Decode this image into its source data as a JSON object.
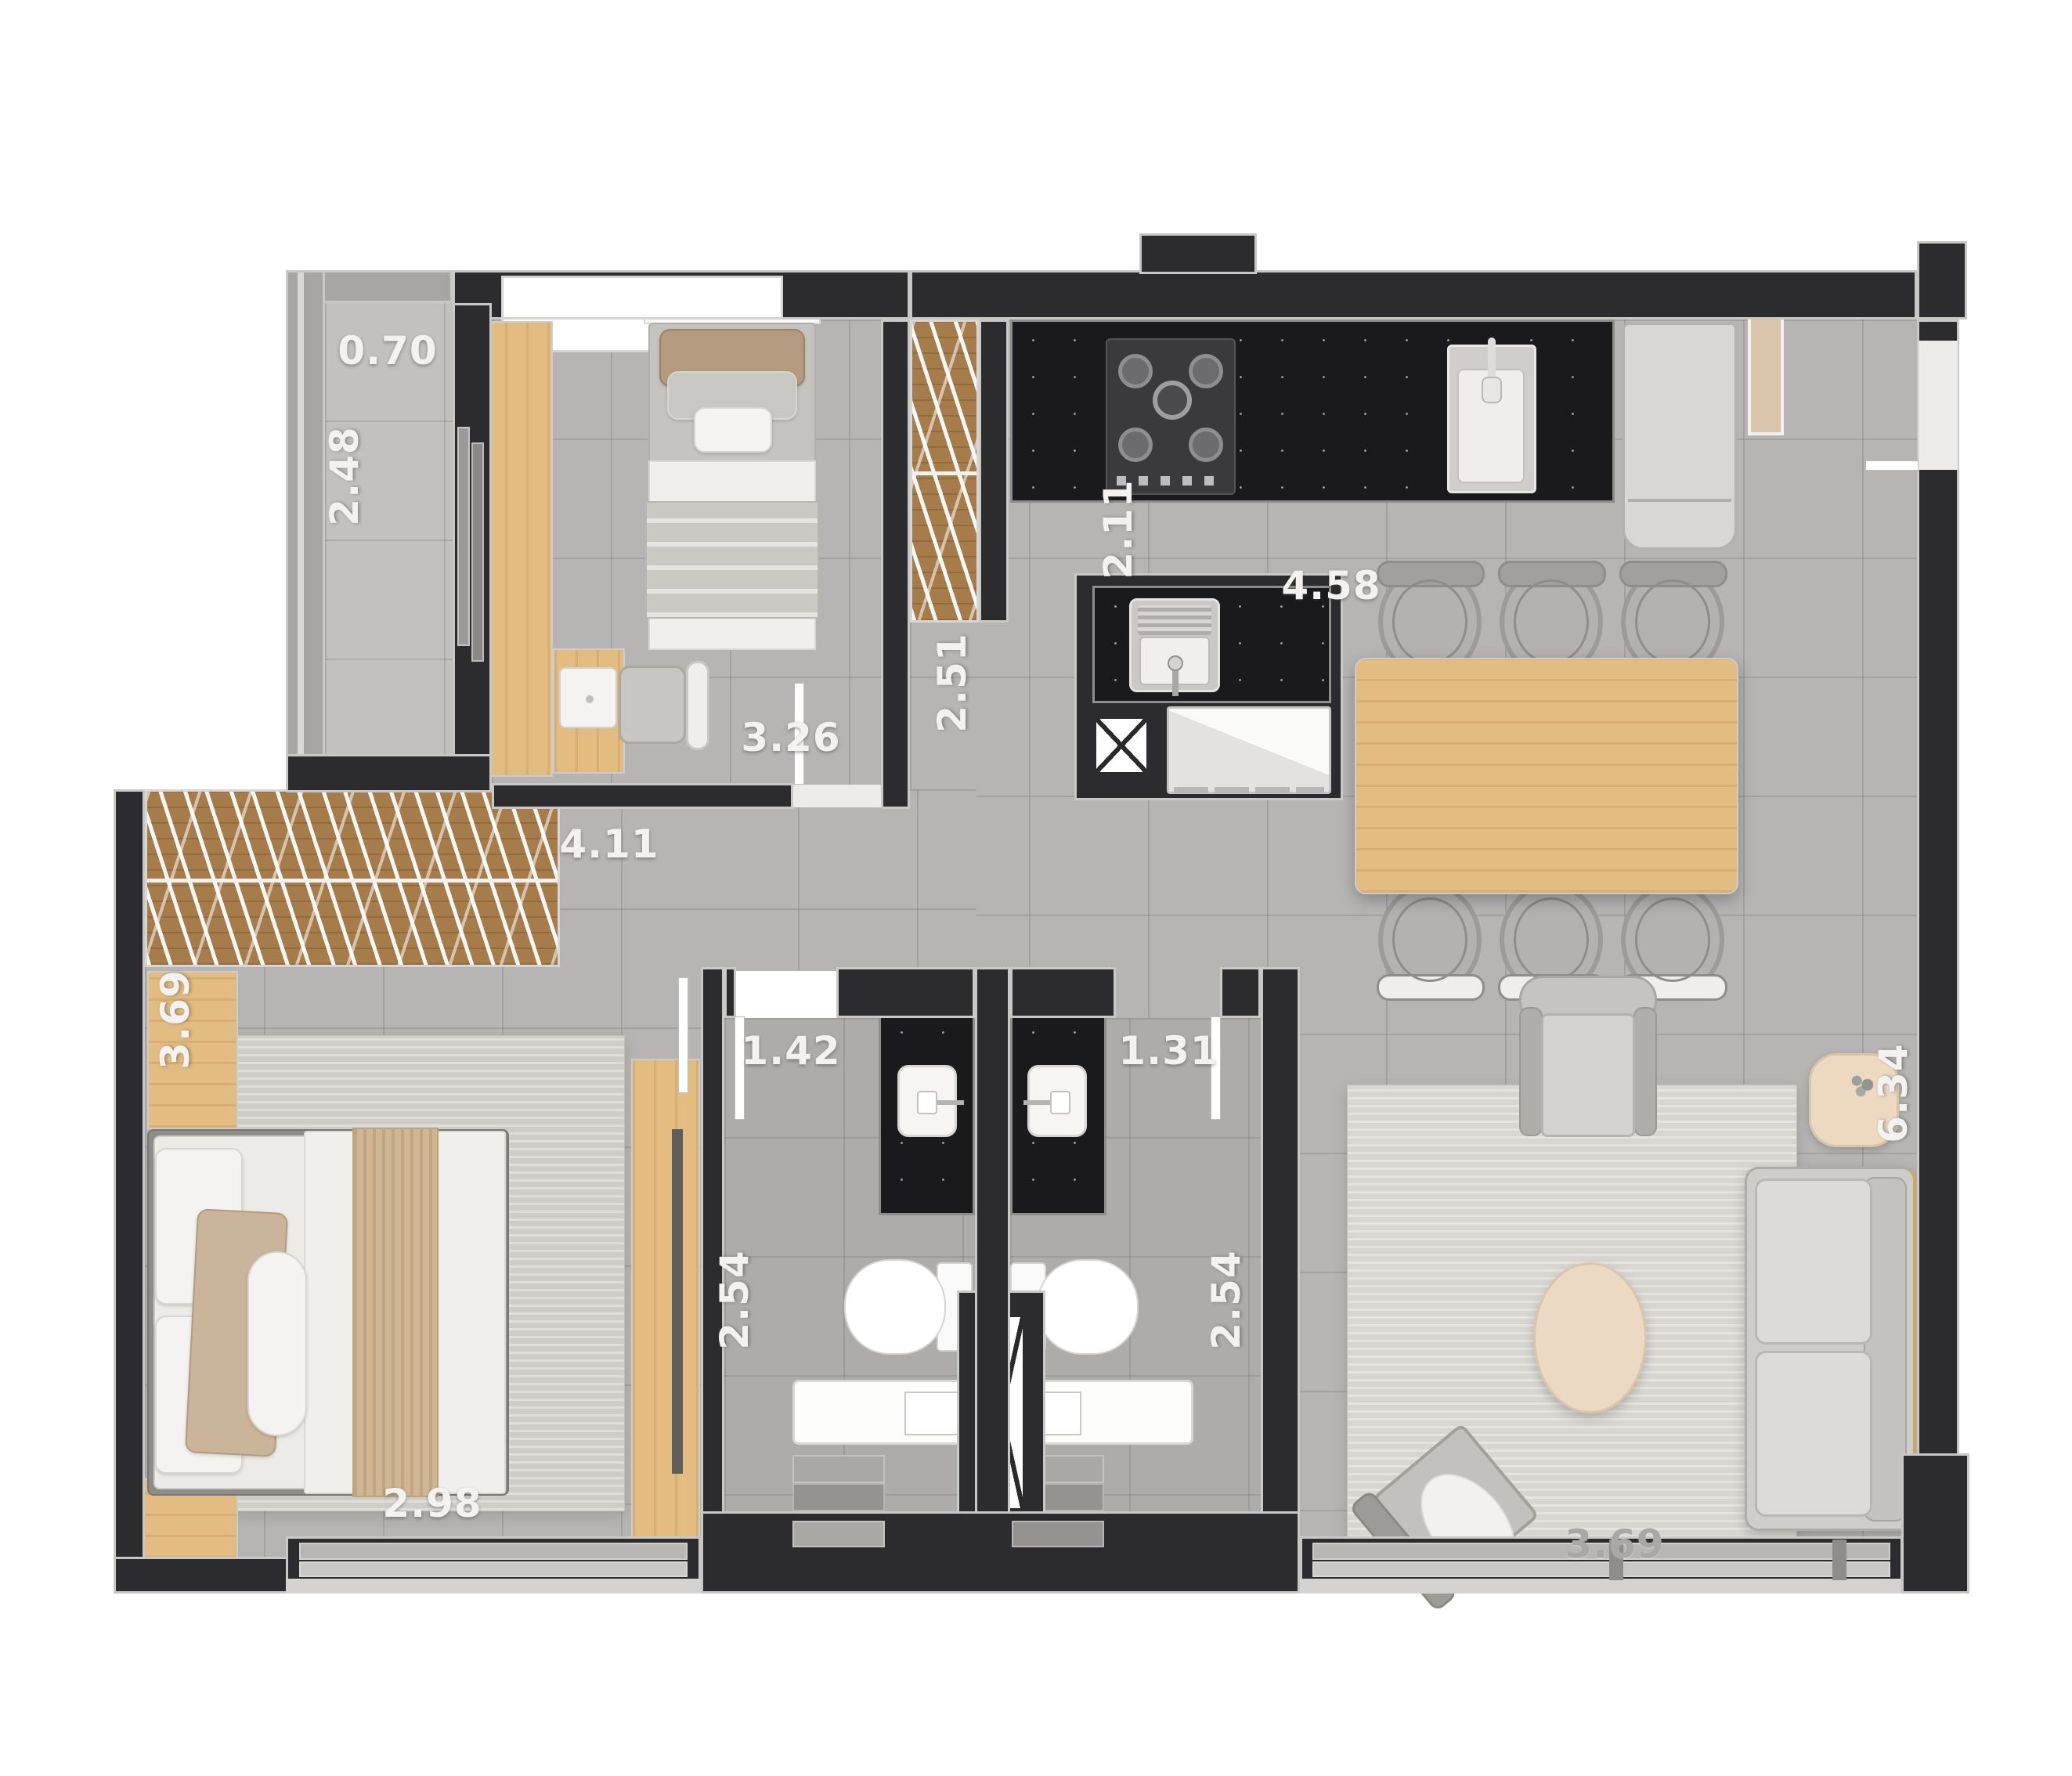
{
  "plan": {
    "type": "apartment-floor-plan-top-view",
    "colors": {
      "background": "#ffffff",
      "wall": "#2c2c2e",
      "wall_outline": "#c8c8c7",
      "floor": "#b6b5b3",
      "balcony_floor": "#c2c1bf",
      "wood_light": "#e3bc82",
      "wood_slat": "#a67c4b",
      "counter_black": "#1a1a1d",
      "rug": "#d8d6d1",
      "fixture_white": "#f7f6f5",
      "label_text": "#f3f2f0"
    },
    "dimensions": {
      "balcony_width": "0.70",
      "balcony_length": "2.48",
      "bedroom2_width": "3.26",
      "bedroom2_depth": "2.51",
      "kitchen_depth": "2.11",
      "kitchen_width": "4.58",
      "living_length": "6.34",
      "hall_width": "4.11",
      "master_depth": "3.69",
      "master_width": "2.98",
      "bath1_width": "1.42",
      "bath1_depth": "2.54",
      "bath2_width": "1.31",
      "bath2_depth": "2.54",
      "living_width": "3.69"
    }
  }
}
